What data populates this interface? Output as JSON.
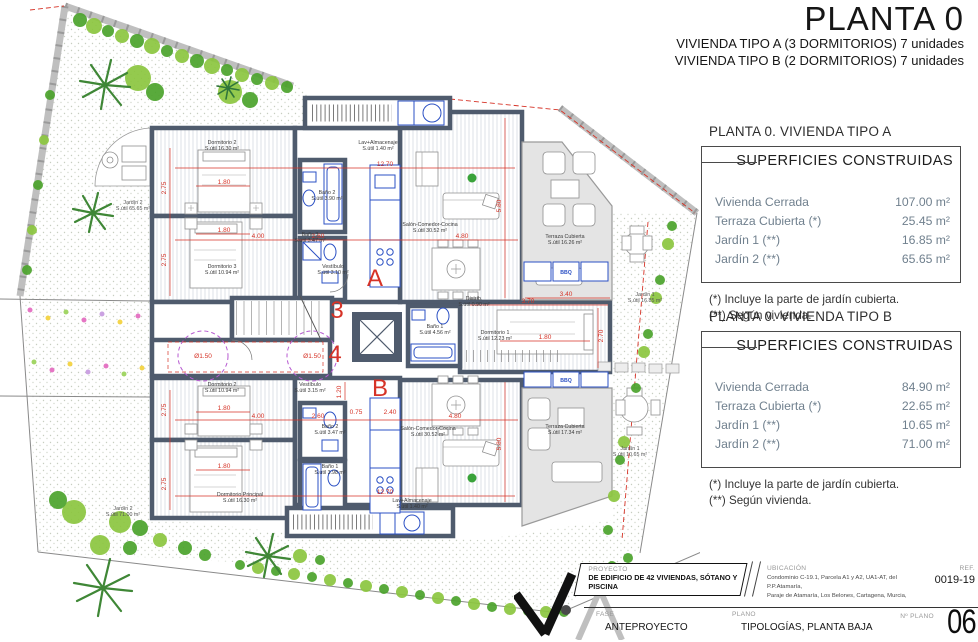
{
  "title": {
    "main": "PLANTA 0",
    "sub1": "VIVIENDA TIPO A (3 DORMITORIOS) 7 unidades",
    "sub2": "VIVIENDA TIPO B (2 DORMITORIOS) 7 unidades"
  },
  "panels": {
    "a": {
      "heading": "PLANTA 0. VIVIENDA TIPO A",
      "table_title": "SUPERFICIES CONSTRUIDAS",
      "rows": [
        {
          "label": "Vivienda Cerrada",
          "value": "107.00 m²"
        },
        {
          "label": "Terraza Cubierta (*)",
          "value": "25.45 m²"
        },
        {
          "label": "Jardín 1 (**)",
          "value": "16.85 m²"
        },
        {
          "label": "Jardín 2 (**)",
          "value": "65.65 m²"
        }
      ],
      "notes": [
        "(*)  Incluye la parte de jardín cubierta.",
        "(**) Según vivienda."
      ]
    },
    "b": {
      "heading": "PLANTA 0. VIVIENDA TIPO B",
      "table_title": "SUPERFICIES CONSTRUIDAS",
      "rows": [
        {
          "label": "Vivienda Cerrada",
          "value": "84.90 m²"
        },
        {
          "label": "Terraza Cubierta (*)",
          "value": "22.65 m²"
        },
        {
          "label": "Jardín 1 (**)",
          "value": "10.65 m²"
        },
        {
          "label": "Jardín 2 (**)",
          "value": "71.00 m²"
        }
      ],
      "notes": [
        "(*) Incluye la parte de jardín cubierta.",
        "(**) Según vivienda."
      ]
    }
  },
  "titleblock": {
    "proyecto_label": "PROYECTO",
    "proyecto": "DE EDIFICIO DE 42 VIVIENDAS, SÓTANO Y PISCINA",
    "ubicacion_label": "UBICACIÓN",
    "ubicacion_line1": "Condominio C-19.1, Parcela A1 y A2, UA1-AT, del P.P.Atamaría,",
    "ubicacion_line2": "Paraje de Atamaría, Los Belones, Cartagena, Murcia,",
    "ref_label": "REF.",
    "ref": "0019-19",
    "fase_label": "FASE",
    "fase": "ANTEPROYECTO",
    "plano_label": "PLANO",
    "plano": "TIPOLOGÍAS, PLANTA BAJA",
    "num_plano_label": "Nº PLANO",
    "num_plano": "06"
  },
  "plan": {
    "marks": {
      "unit_a": "A",
      "unit_b": "B",
      "portal_3": "3",
      "portal_4": "4",
      "turning_circle": "Ø1.50",
      "bbq": "BBQ"
    },
    "rooms": {
      "a_dorm2": {
        "n": "Dormitorio 2",
        "a": "S.útil 16.30 m²"
      },
      "a_dorm3": {
        "n": "Dormitorio 3",
        "a": "S.útil 10.94 m²"
      },
      "a_dorm1": {
        "n": "Dormitorio 1",
        "a": "S.útil 12.23 m²"
      },
      "a_bano1": {
        "n": "Baño 1",
        "a": "S.útil 4.56 m²"
      },
      "a_bano2": {
        "n": "Baño 2",
        "a": "S.útil 3.90 m²"
      },
      "a_bano3": {
        "n": "Baño 3",
        "a": "S.útil 3.47 m²"
      },
      "a_vest": {
        "n": "Vestíbulo",
        "a": "S.útil 3.10 m²"
      },
      "a_distrib": {
        "n": "Distrib.",
        "a": "S.útil 0.90 m²"
      },
      "a_lav": {
        "n": "Lav+Almacenaje",
        "a": "S.útil 1.40 m²"
      },
      "a_salon": {
        "n": "Salón-Comedor-Cocina",
        "a": "S.útil 30.52 m²"
      },
      "a_terr": {
        "n": "Terraza Cubierta",
        "a": "S.útil 16.26 m²"
      },
      "b_dorm2": {
        "n": "Dormitorio 2",
        "a": "S.útil 10.94 m²"
      },
      "b_dormp": {
        "n": "Dormitorio Principal",
        "a": "S.útil 16.30 m²"
      },
      "b_bano1": {
        "n": "Baño 1",
        "a": "S.útil 3.98 m²"
      },
      "b_bano2": {
        "n": "Baño 2",
        "a": "S.útil 3.47 m²"
      },
      "b_vest": {
        "n": "Vestíbulo",
        "a": "S.útil 3.15 m²"
      },
      "b_lav": {
        "n": "Lav+Almacenaje",
        "a": "S.útil 1.40 m²"
      },
      "b_salon": {
        "n": "Salón-Comedor-Cocina",
        "a": "S.útil 30.52 m²"
      },
      "b_terr": {
        "n": "Terraza Cubierta",
        "a": "S.útil 17.34 m²"
      },
      "j2t": {
        "n": "Jardín 2",
        "a": "S.útil 65.65 m²"
      },
      "j2b": {
        "n": "Jardín 2",
        "a": "S.útil 71.00 m²"
      },
      "j1t": {
        "n": "Jardín 1",
        "a": "S.útil 16.85 m²"
      },
      "j1b": {
        "n": "Jardín 1",
        "a": "S.útil 10.65 m²"
      }
    },
    "dims": {
      "d075": "0.75",
      "d120": "1.20",
      "d180": "1.80",
      "d240": "2.40",
      "d260": "2.60",
      "d270": "2.70",
      "d275": "2.75",
      "d340": "3.40",
      "d370": "3.70",
      "d400": "4.00",
      "d480": "4.80",
      "d580": "5.80",
      "d1270": "12.70"
    }
  },
  "colors": {
    "wall": "#4f5b6d",
    "dim_red": "#d63327",
    "fixture_blue": "#2b50c4",
    "terrace_grey": "#e4e4e4",
    "green_light": "#8cc63f",
    "green_dark": "#2f7d26"
  }
}
